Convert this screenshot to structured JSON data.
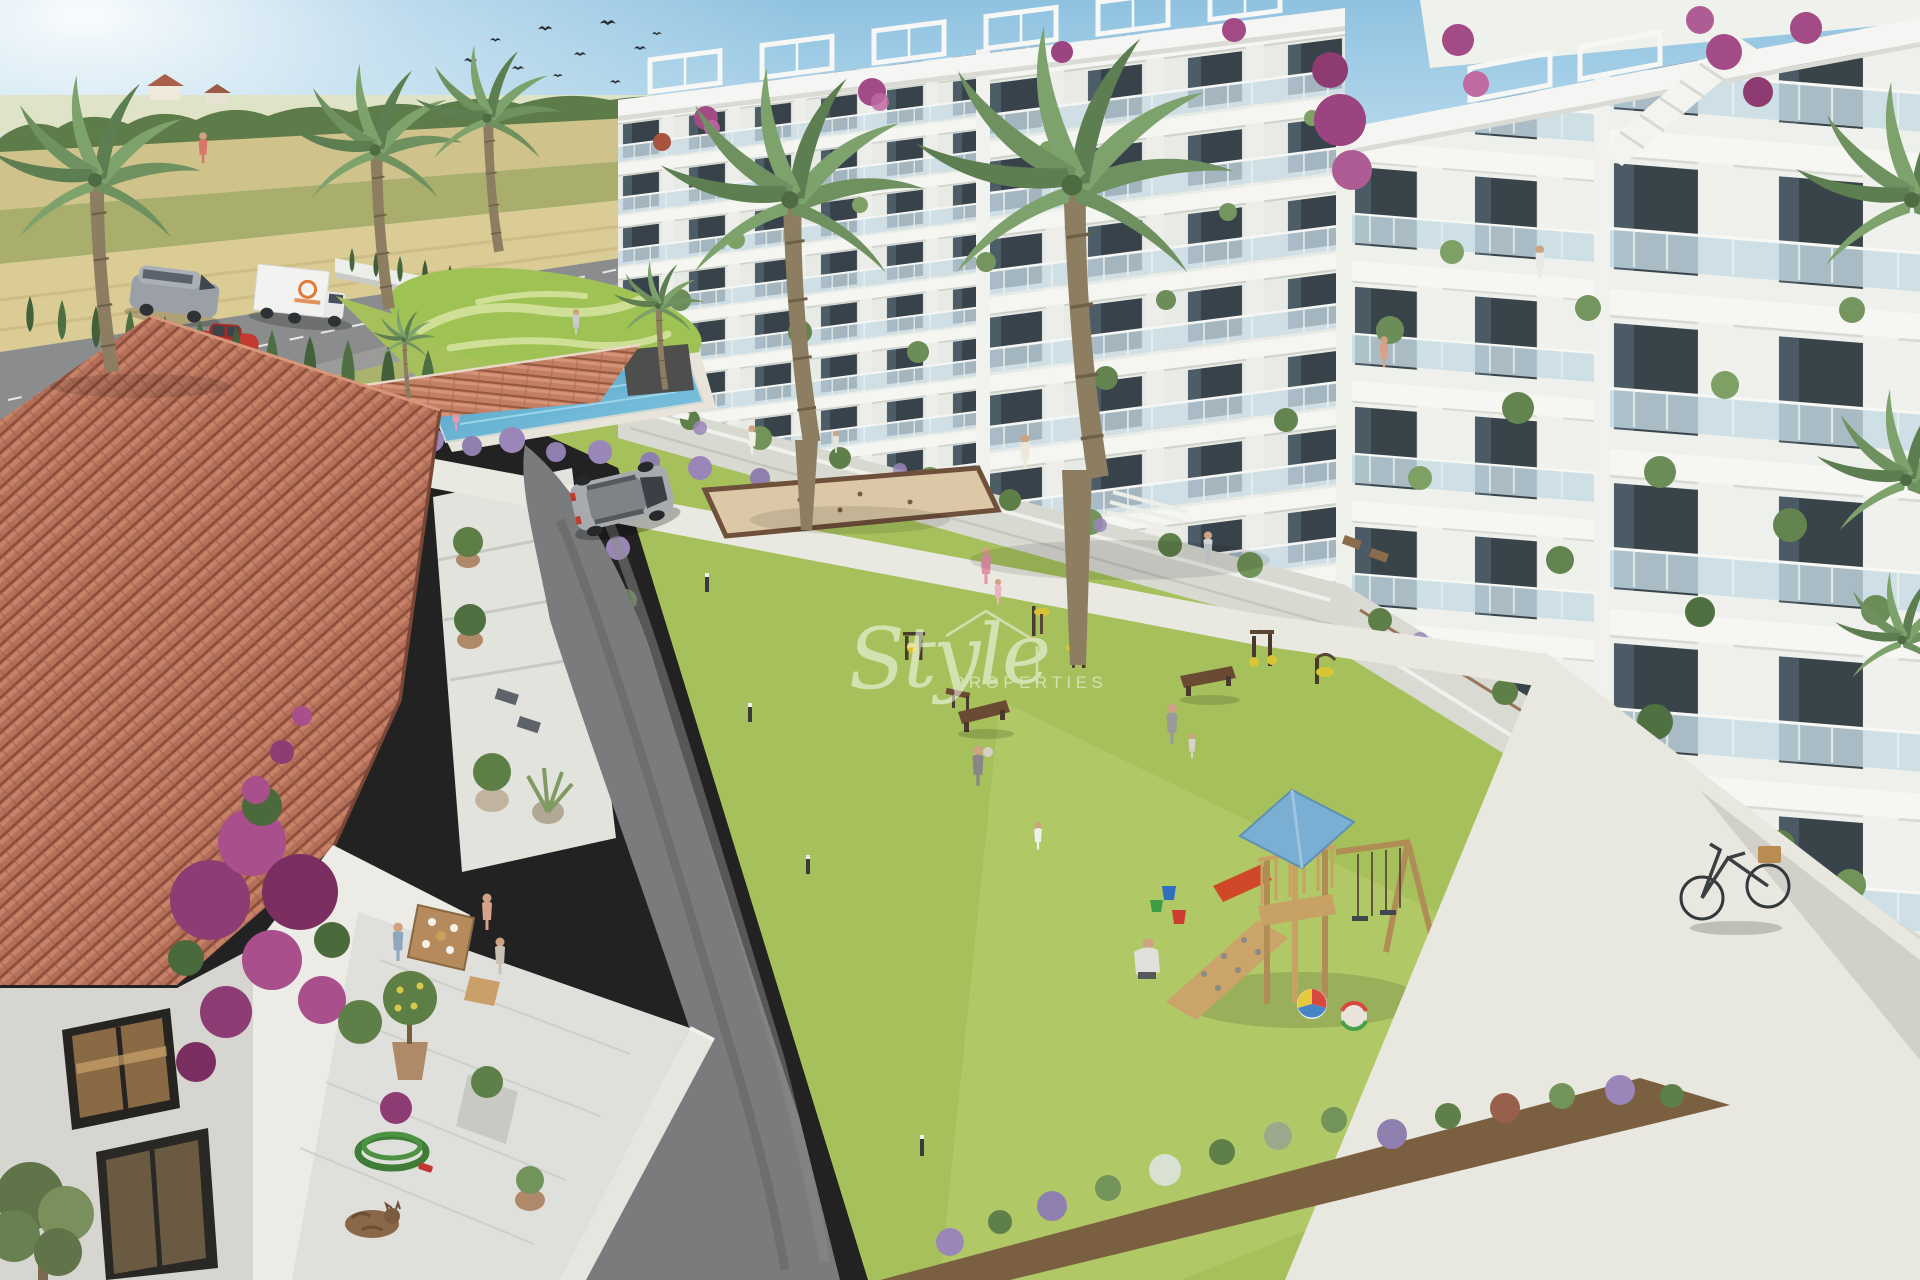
{
  "watermark": {
    "script": "Style",
    "caption": "PROPERTIES",
    "icon": "roof-outline-icon"
  },
  "scene": {
    "description": "Aerial 3D rendering of a modern white apartment complex with communal lawn, pool, playground and an old tiled-roof country house in the foreground",
    "objects": [
      "sky",
      "flock-of-birds",
      "farm-fields",
      "country-road",
      "delivery-van",
      "box-truck",
      "red-car",
      "cypress-hedge",
      "palm-trees",
      "apartment-buildings",
      "balconies-with-plants",
      "bougainvillea",
      "swimming-pool",
      "ornamental-green",
      "central-lawn",
      "petanque-court",
      "outdoor-gym",
      "benches",
      "people",
      "playground-tower",
      "swing-set",
      "beach-balls",
      "toy-buckets",
      "bicycle",
      "silver-suv",
      "asphalt-drive",
      "tiled-roof-house",
      "terrace-diners",
      "garden-hose",
      "sleeping-cat",
      "olive-tree",
      "paved-plaza",
      "watermark"
    ]
  },
  "palette": {
    "sky": "#9ccbe6",
    "grass": "#a6c15c",
    "grass_dull": "#a9b36c",
    "pool_water": "#5fb0d4",
    "roof_tile": "#b56f58",
    "asphalt": "#7a7b7d",
    "pavement": "#e9e8e0",
    "sand": "#dcc8a6",
    "building": "#f5f6f3",
    "house_wall": "#ecebe5",
    "house_wall_shade": "#d7d5cf",
    "glass": "#c6dbe5",
    "lavender": "#9a86b8",
    "bougainvillea": "#a2498a",
    "palm": "#74936a",
    "watermark": "#ffffff"
  }
}
